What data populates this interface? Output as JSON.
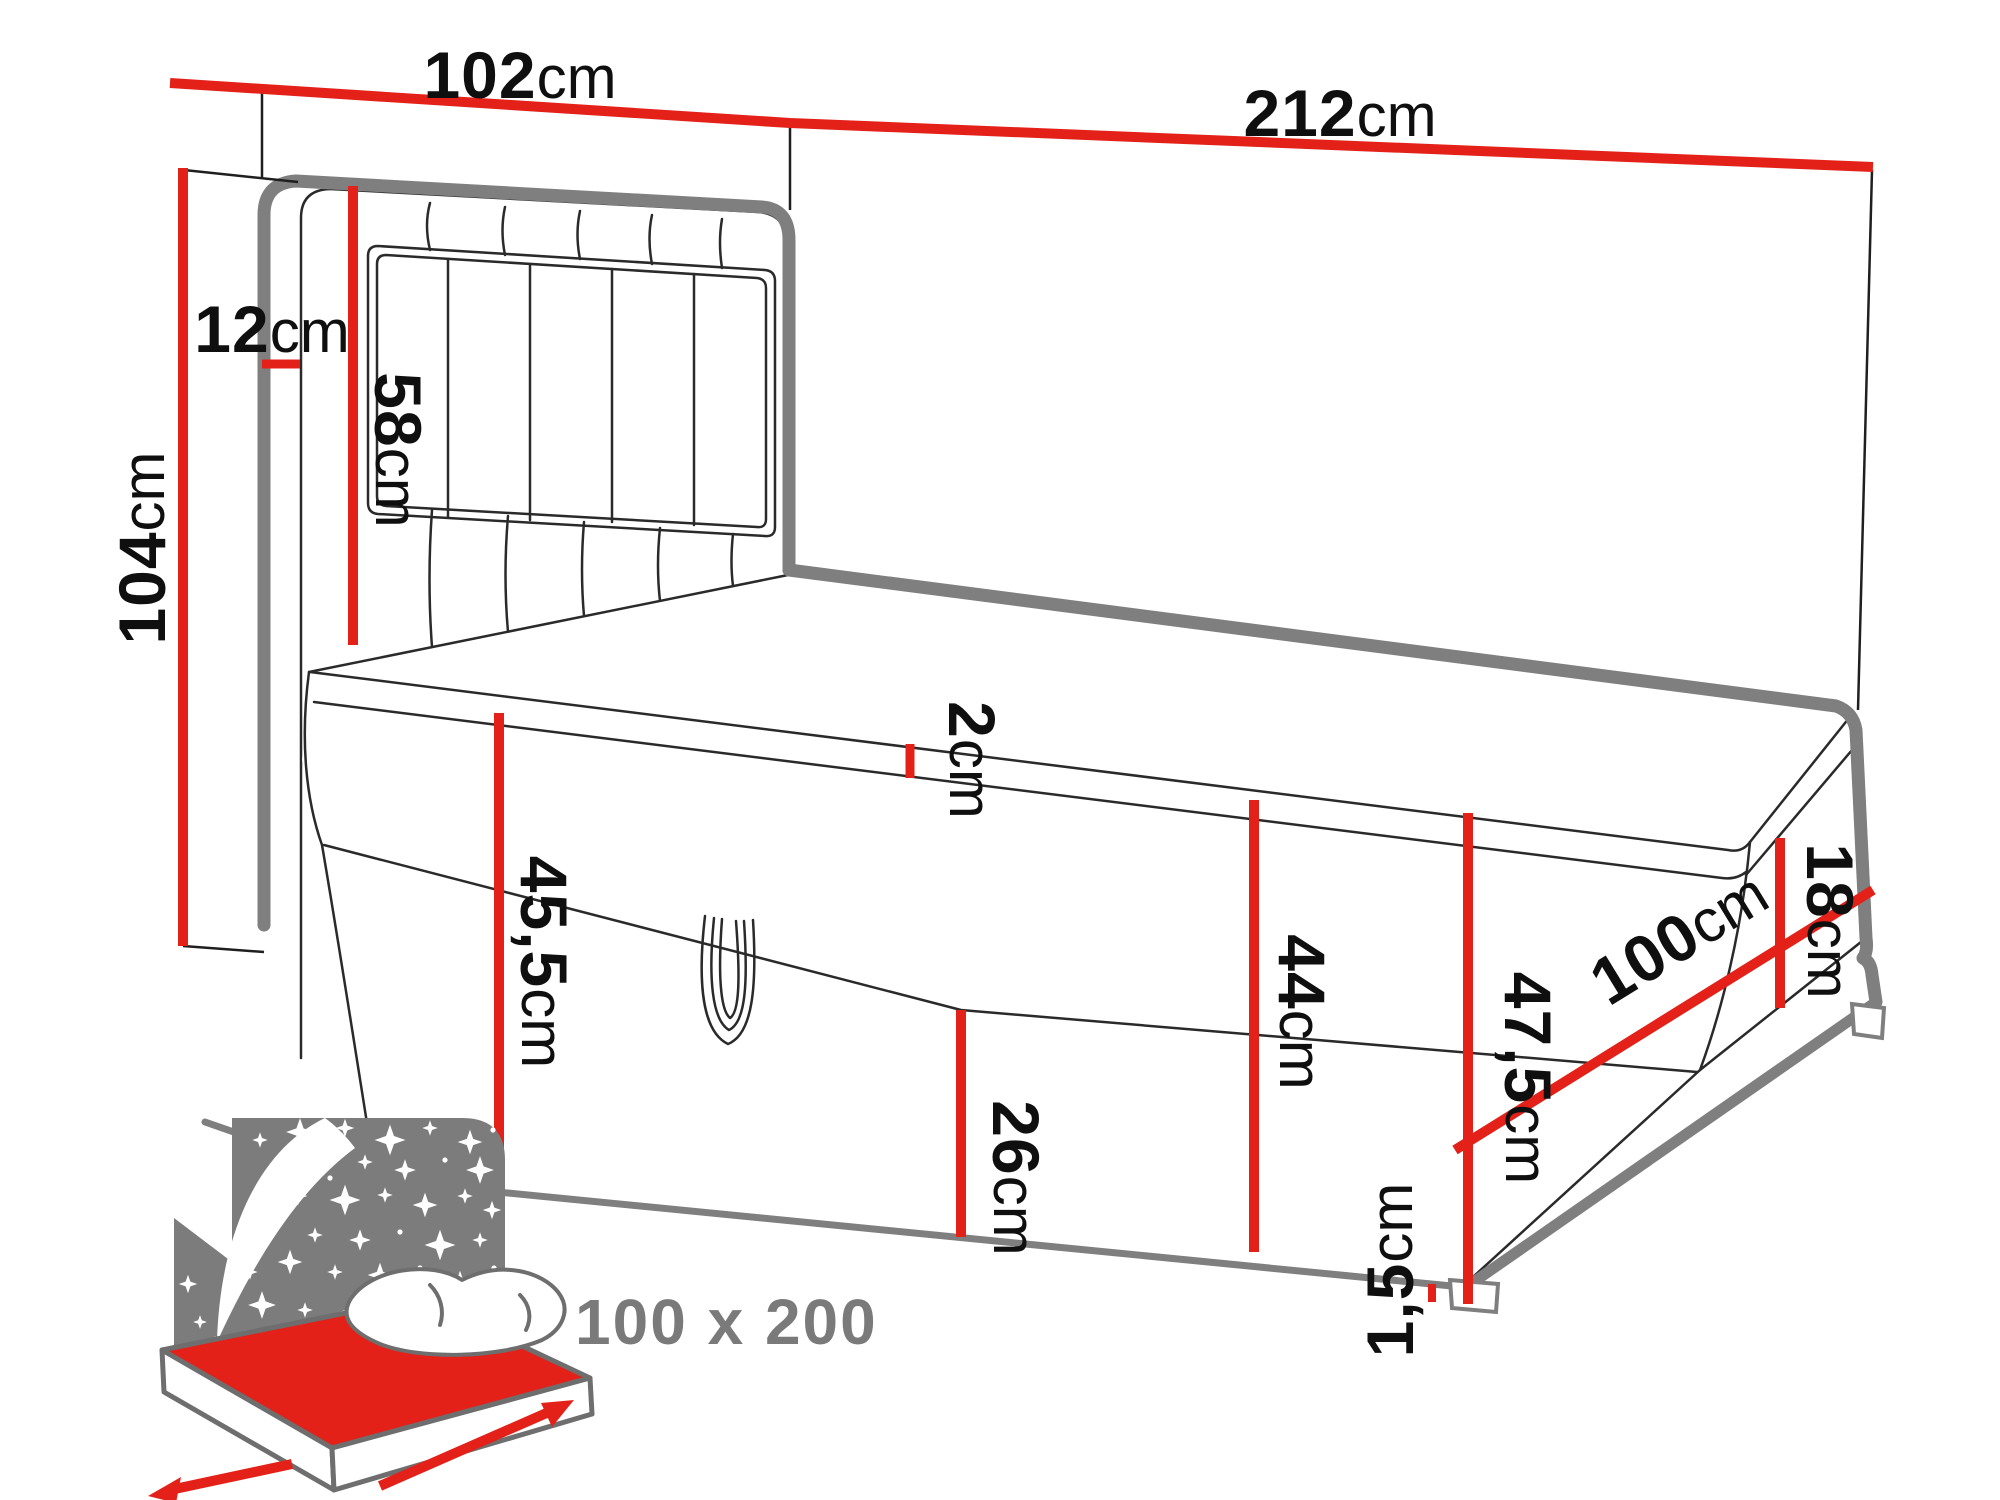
{
  "diagram": {
    "title": "bed-dimension-diagram",
    "colors": {
      "dimension_red": "#e32119",
      "outline_grey": "#7f7f7f",
      "outline_black": "#2a2a2a",
      "icon_grey": "#7c7c7c",
      "label_text": "#0f0f0f",
      "caption_text": "#7a7a7a"
    },
    "dimensions": [
      {
        "id": "headboard-width",
        "value": "102",
        "unit": "cm"
      },
      {
        "id": "total-length",
        "value": "212",
        "unit": "cm"
      },
      {
        "id": "total-height",
        "value": "104",
        "unit": "cm"
      },
      {
        "id": "headboard-depth",
        "value": "12",
        "unit": "cm"
      },
      {
        "id": "headboard-above-mattress",
        "value": "58",
        "unit": "cm"
      },
      {
        "id": "topper-thickness",
        "value": "2",
        "unit": "cm"
      },
      {
        "id": "side-height",
        "value": "45,5",
        "unit": "cm"
      },
      {
        "id": "storage-front-height",
        "value": "26",
        "unit": "cm"
      },
      {
        "id": "base-box-height",
        "value": "44",
        "unit": "cm"
      },
      {
        "id": "mattress-thickness",
        "value": "18",
        "unit": "cm"
      },
      {
        "id": "foot-end-height",
        "value": "47,5",
        "unit": "cm"
      },
      {
        "id": "bed-width",
        "value": "100",
        "unit": "cm"
      },
      {
        "id": "feet-height",
        "value": "1,5",
        "unit": "cm"
      }
    ],
    "icon_caption": "100 x 200"
  }
}
